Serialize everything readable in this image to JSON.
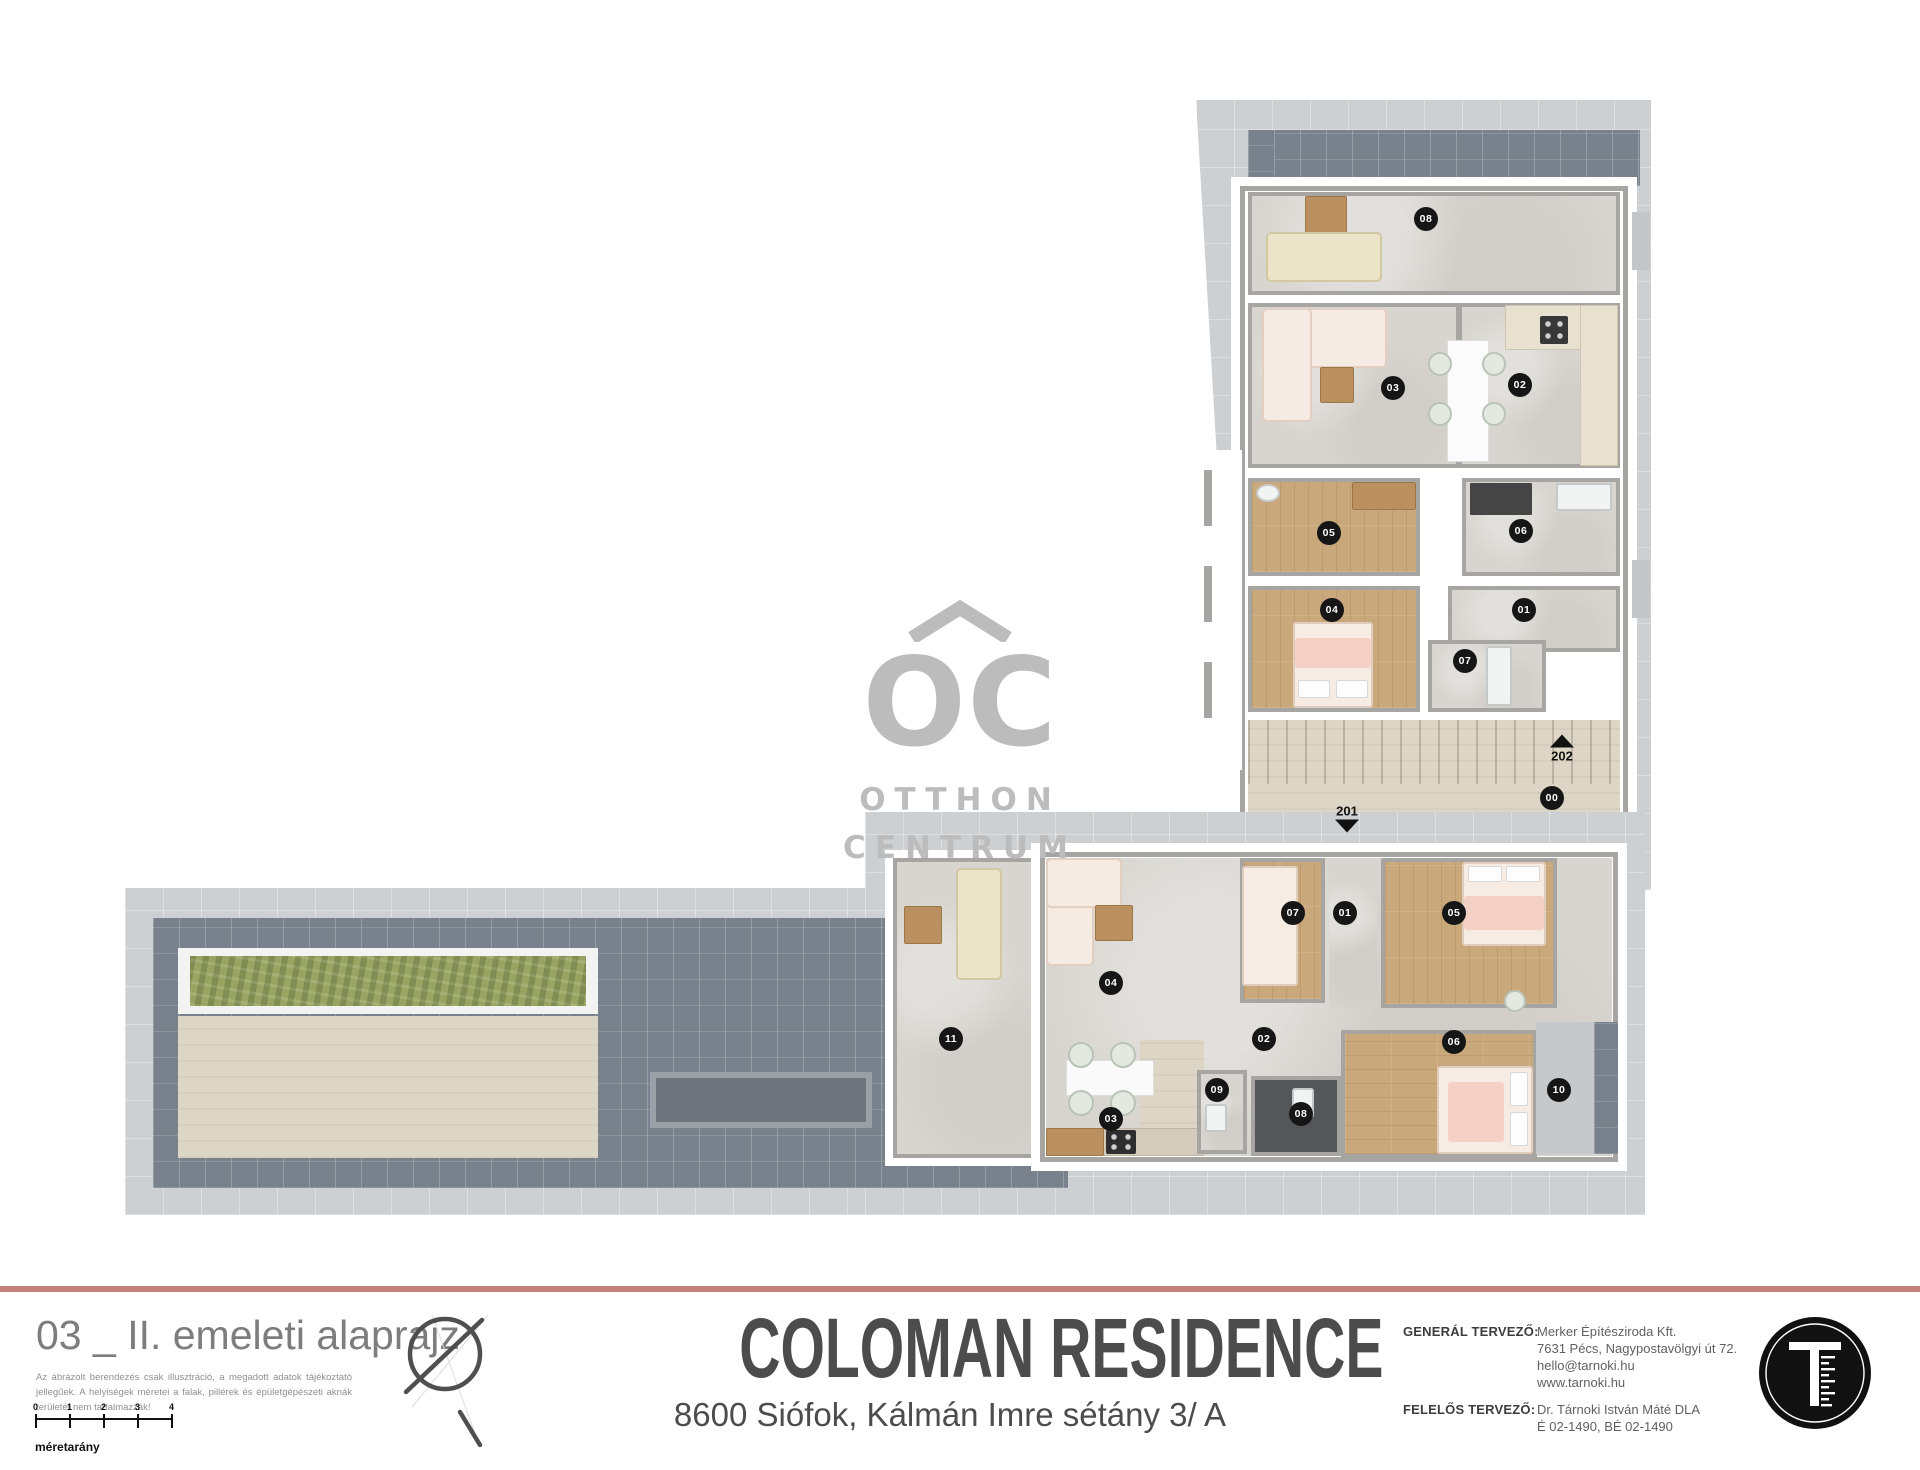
{
  "watermark": {
    "brand_mark": "OC",
    "line1": "OTTHON",
    "line2": "CENTRUM"
  },
  "plan": {
    "unit_markers": [
      {
        "label": "08",
        "x": 1426,
        "y": 219
      },
      {
        "label": "03",
        "x": 1393,
        "y": 388
      },
      {
        "label": "02",
        "x": 1520,
        "y": 385
      },
      {
        "label": "05",
        "x": 1329,
        "y": 533
      },
      {
        "label": "06",
        "x": 1521,
        "y": 531
      },
      {
        "label": "04",
        "x": 1332,
        "y": 610
      },
      {
        "label": "01",
        "x": 1524,
        "y": 610
      },
      {
        "label": "07",
        "x": 1465,
        "y": 661
      },
      {
        "label": "00",
        "x": 1552,
        "y": 798
      },
      {
        "label": "07",
        "x": 1293,
        "y": 913
      },
      {
        "label": "01",
        "x": 1345,
        "y": 913
      },
      {
        "label": "05",
        "x": 1454,
        "y": 913
      },
      {
        "label": "04",
        "x": 1111,
        "y": 983
      },
      {
        "label": "11",
        "x": 951,
        "y": 1039
      },
      {
        "label": "02",
        "x": 1264,
        "y": 1039
      },
      {
        "label": "06",
        "x": 1454,
        "y": 1042
      },
      {
        "label": "09",
        "x": 1217,
        "y": 1090
      },
      {
        "label": "10",
        "x": 1559,
        "y": 1090
      },
      {
        "label": "08",
        "x": 1301,
        "y": 1114
      },
      {
        "label": "03",
        "x": 1111,
        "y": 1119
      }
    ],
    "stair_arrows": [
      {
        "label": "202",
        "x": 1562,
        "y": 749,
        "dir": "up"
      },
      {
        "label": "201",
        "x": 1347,
        "y": 818,
        "dir": "down"
      }
    ]
  },
  "footer": {
    "sheet_title": "03 _ II. emeleti alaprajz",
    "disclaimer": "Az ábrázolt berendezés csak illusztráció, a megadott adatok tájékoztató jellegűek. A helyiségek méretei a falak, pillérek és épületgépészeti aknák területét nem tartalmazzák!",
    "scale_ticks": [
      "0",
      "1",
      "2",
      "3",
      "4"
    ],
    "scale_label": "méretarány",
    "project_name": "COLOMAN RESIDENCE",
    "project_address": "8600 Siófok, Kálmán Imre sétány 3/ A",
    "general_designer_label": "GENERÁL TERVEZŐ:",
    "general_designer_lines": [
      "Merker Építésziroda Kft.",
      "7631 Pécs, Nagypostavölgyi út 72.",
      "hello@tarnoki.hu",
      "www.tarnoki.hu"
    ],
    "responsible_designer_label": "FELELŐS TERVEZŐ:",
    "responsible_designer_lines": [
      "Dr. Tárnoki István Máté DLA",
      "É 02-1490, BÉ 02-1490"
    ],
    "logo_letter": "T"
  },
  "colors": {
    "accent_divider": "#c5827d",
    "roof_tile": "#79828c",
    "deck": "#cdd0d3",
    "concrete_floor": "#d8d5d0",
    "travertine_floor": "#ddd6c7",
    "wood_floor": "#c9a87c",
    "planter_green": "#9aa566",
    "marker_black": "#161616",
    "watermark_gray": "#bcbcbc"
  }
}
